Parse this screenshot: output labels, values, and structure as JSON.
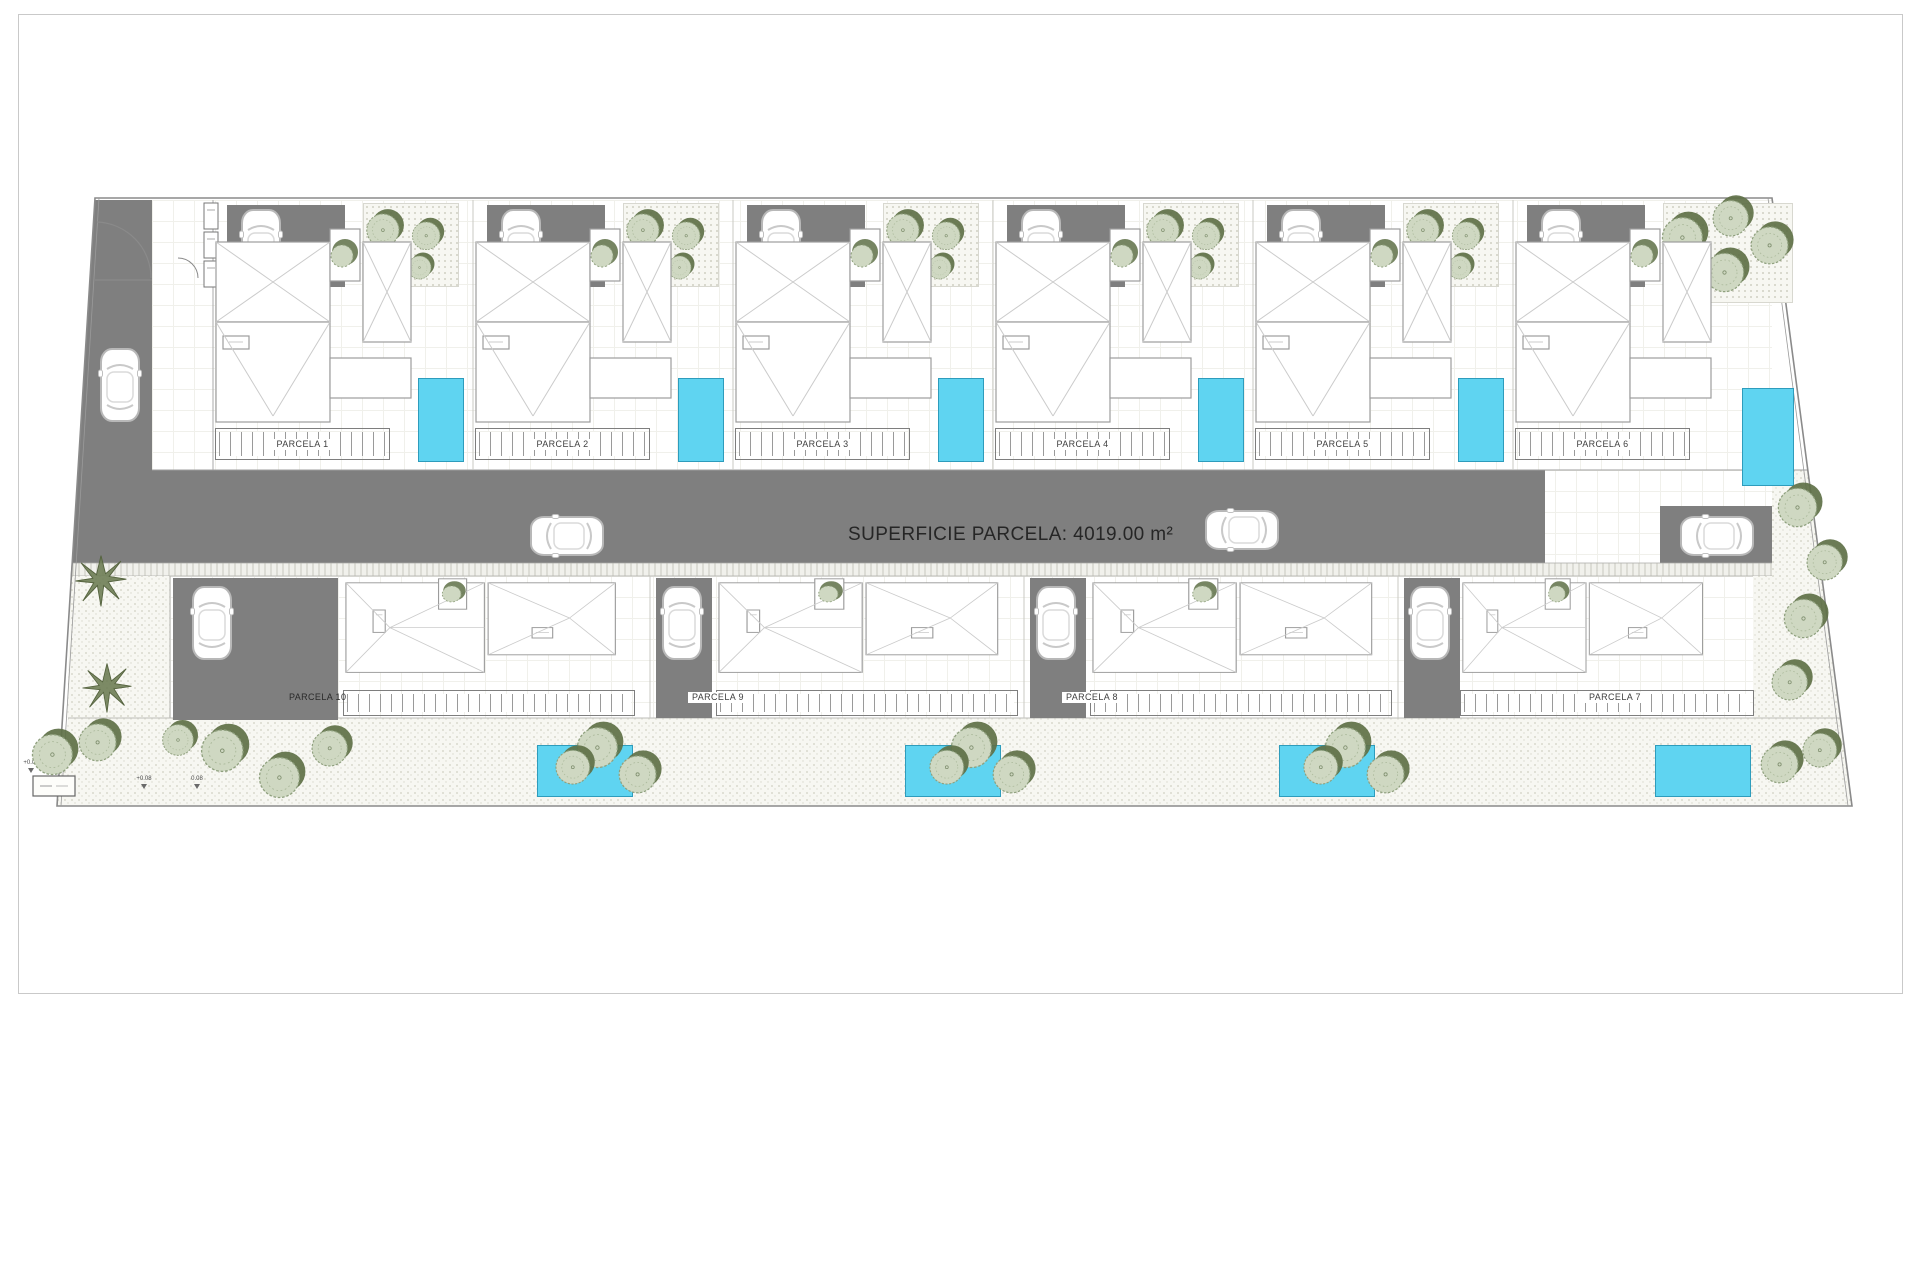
{
  "road": {
    "area_label": "SUPERFICIE PARCELA: 4019.00 m²"
  },
  "parcels": {
    "top": [
      {
        "label": "PARCELA 1"
      },
      {
        "label": "PARCELA 2"
      },
      {
        "label": "PARCELA 3"
      },
      {
        "label": "PARCELA 4"
      },
      {
        "label": "PARCELA 5"
      },
      {
        "label": "PARCELA 6"
      }
    ],
    "bottom": [
      {
        "label": "PARCELA 10"
      },
      {
        "label": "PARCELA 9"
      },
      {
        "label": "PARCELA 8"
      },
      {
        "label": "PARCELA 7"
      }
    ]
  },
  "site_markers": {
    "levels": [
      {
        "value": "+0.08"
      },
      {
        "value": "+0.08"
      },
      {
        "value": "0.08"
      }
    ]
  },
  "colors": {
    "road": "#7f7f7f",
    "driveway": "#7f7f7f",
    "pool": "#5fd4f1",
    "pool_border": "#2e9cbc",
    "tree_dark": "#5e7046",
    "tree_light": "#cfd8c2",
    "boundary": "#8a8a8a",
    "page_border": "#c9c9c9"
  },
  "icons": {
    "car": "car-icon",
    "tree": "tree-icon",
    "palm": "palm-tree-icon",
    "gate": "gate-swing-icon"
  }
}
